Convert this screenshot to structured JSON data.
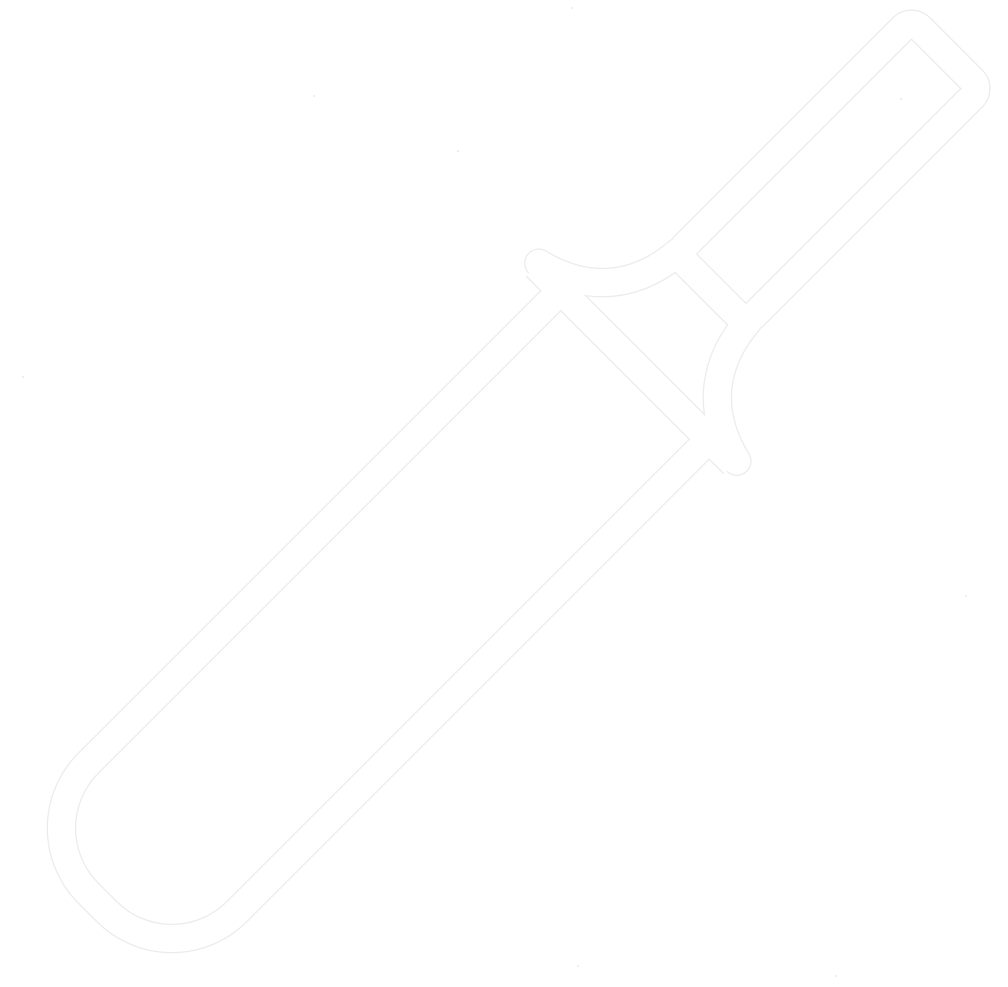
{
  "canvas": {
    "width_px": 1008,
    "height_px": 987,
    "background_color": "#ffffff"
  },
  "icon": {
    "name": "cricket-bat-icon",
    "label": "Cricket bat",
    "style": "outline",
    "stroke_color": "#ffffff",
    "edge_color": "#ebebeb",
    "rotation_deg": 45,
    "orientation": "handle toward top-right, blade toward bottom-left"
  }
}
